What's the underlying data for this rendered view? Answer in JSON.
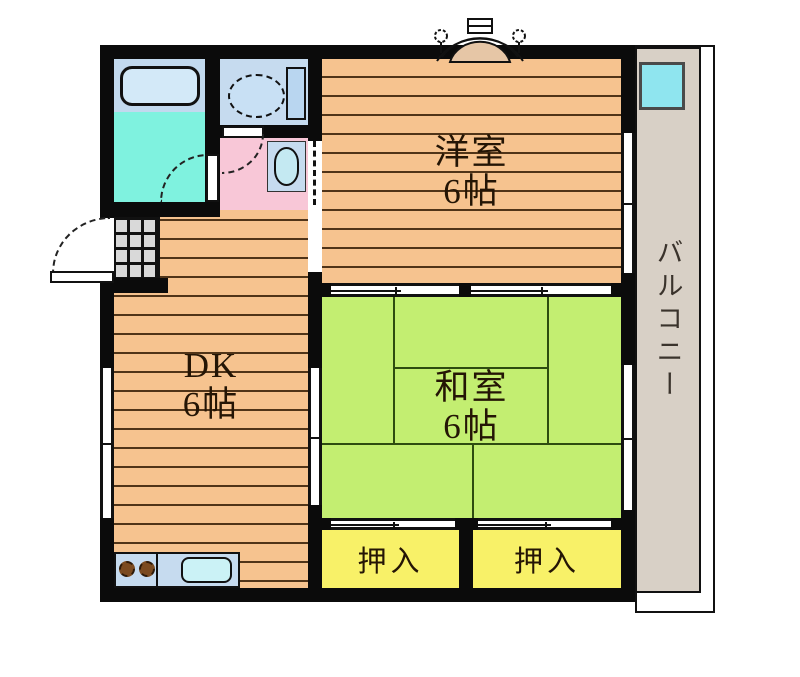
{
  "plan_title": "2DK apartment floor plan",
  "rooms": {
    "western": {
      "label": "洋室",
      "size": "6帖",
      "floor_color": "#F6C38F"
    },
    "dining_kitchen": {
      "label": "DK",
      "size": "6帖",
      "floor_color": "#F6C38F"
    },
    "japanese": {
      "label": "和室",
      "size": "6帖",
      "floor_color": "#C3EE71"
    },
    "closet_left": {
      "label": "押入",
      "floor_color": "#F8F168"
    },
    "closet_right": {
      "label": "押入",
      "floor_color": "#F8F168"
    },
    "balcony": {
      "label": "バルコニー",
      "floor_color": "#D8D0C6"
    }
  },
  "fixtures": [
    "bathtub",
    "bathroom-floor",
    "toilet",
    "washbasin",
    "entrance-tile",
    "kitchen-counter",
    "stove-burners",
    "kitchen-sink",
    "balcony-washer-pan",
    "bay-window"
  ],
  "colors": {
    "wall": "#0b0b0b",
    "wood_floor": "#F6C38F",
    "wood_line": "#503418",
    "tatami": "#C3EE71",
    "tatami_line": "#2e4c10",
    "closet_yellow": "#F8F168",
    "balcony_gray": "#D8D0C6",
    "bath_floor_cyan": "#7FF2DF",
    "fixture_blue": "#C6DBEF",
    "washroom_pink": "#F8C7D7",
    "genkan_tile_gray": "#D9D9D9",
    "balcony_pan_cyan": "#8FE5EF",
    "sink_cyan": "#CBF2F6",
    "burner_brown": "#7B4A1F"
  }
}
